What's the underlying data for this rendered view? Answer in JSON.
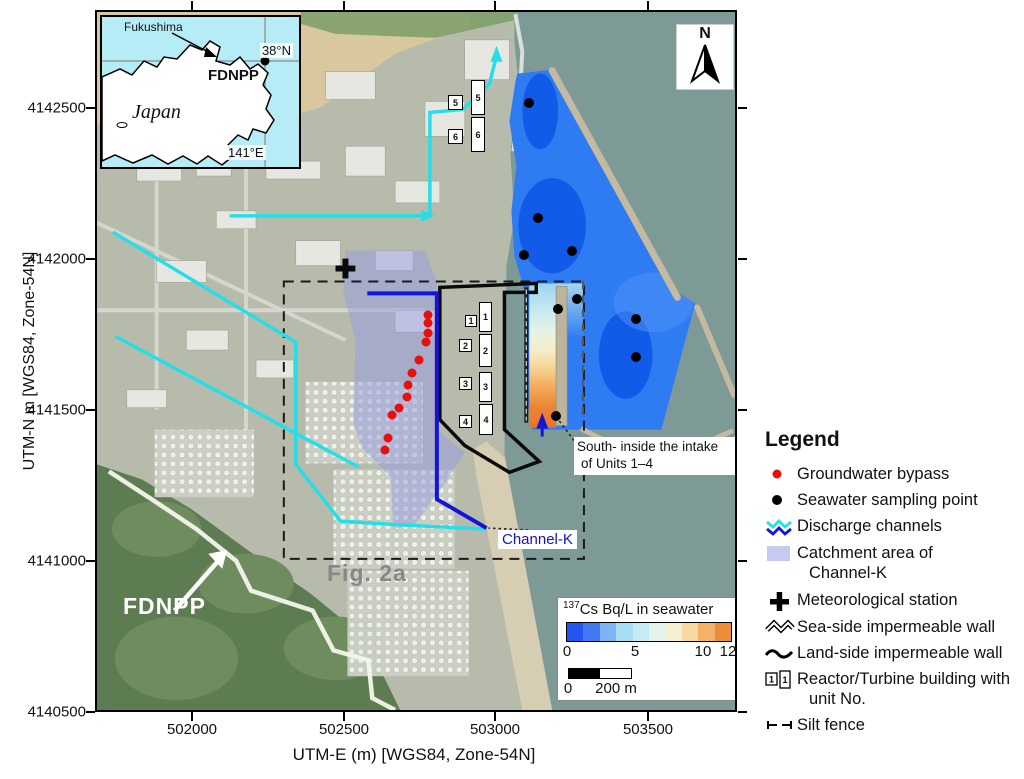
{
  "axes": {
    "y_title": "UTM-N m [WGS84, Zone-54N]",
    "x_title": "UTM-E (m) [WGS84, Zone-54N]",
    "y_ticks": [
      "4142500",
      "4142000",
      "4141500",
      "4141000",
      "4140500"
    ],
    "x_ticks": [
      "502000",
      "502500",
      "503000",
      "503500"
    ]
  },
  "inset": {
    "country": "Japan",
    "prefecture": "Fukushima",
    "site": "FDNPP",
    "lat_line": "38°N",
    "lon_line": "141°E"
  },
  "map": {
    "north_label": "N",
    "fig_label": "Fig. 2a",
    "site_label": "FDNPP",
    "channel_label": "Channel-K",
    "intake_label_line1": "South- inside the intake",
    "intake_label_line2": "of Units 1–4",
    "unit_numbers": [
      "1",
      "2",
      "3",
      "4",
      "5",
      "6"
    ],
    "groundwater_bypass_points": [
      [
        331,
        303
      ],
      [
        331,
        311
      ],
      [
        331,
        321
      ],
      [
        329,
        330
      ],
      [
        322,
        348
      ],
      [
        315,
        361
      ],
      [
        311,
        373
      ],
      [
        310,
        385
      ],
      [
        302,
        396
      ],
      [
        295,
        403
      ],
      [
        291,
        426
      ],
      [
        288,
        438
      ]
    ],
    "seawater_sampling_points": [
      [
        432,
        91
      ],
      [
        441,
        206
      ],
      [
        427,
        243
      ],
      [
        475,
        239
      ],
      [
        461,
        297
      ],
      [
        480,
        287
      ],
      [
        539,
        307
      ],
      [
        539,
        345
      ],
      [
        459,
        404
      ]
    ]
  },
  "colorbar": {
    "isotope_sup": "137",
    "title_rest": "Cs Bq/L in seawater",
    "tick_labels": [
      "0",
      "5",
      "10",
      "12"
    ],
    "segment_colors": [
      "#2356ee",
      "#4479f2",
      "#7db4f5",
      "#a6ddf2",
      "#c5ecf2",
      "#e4f4ea",
      "#f6efd2",
      "#f8d9a2",
      "#f4b167",
      "#ee8c3c"
    ],
    "scale_start": "0",
    "scale_end": "200 m"
  },
  "legend": {
    "title": "Legend",
    "building_icon_number": "1",
    "items": [
      {
        "icon": "red-dot",
        "lines": [
          "Groundwater bypass"
        ]
      },
      {
        "icon": "black-dot",
        "lines": [
          "Seawater sampling point"
        ]
      },
      {
        "icon": "channels",
        "lines": [
          "Discharge channels"
        ]
      },
      {
        "icon": "catchment",
        "lines": [
          "Catchment area of",
          "Channel-K"
        ]
      },
      {
        "icon": "met-station",
        "lines": [
          "Meteorological station"
        ]
      },
      {
        "icon": "sea-wall",
        "lines": [
          "Sea-side impermeable wall"
        ]
      },
      {
        "icon": "land-wall",
        "lines": [
          "Land-side impermeable wall"
        ]
      },
      {
        "icon": "building",
        "lines": [
          "Reactor/Turbine building with",
          "unit No."
        ]
      },
      {
        "icon": "silt-fence",
        "lines": [
          "Silt fence"
        ]
      }
    ]
  },
  "colors": {
    "harbor": "#2f7cf2",
    "harbor_low": "#0f58e8",
    "channel_cyan": "#24dfe8",
    "channel_blue": "#1414d6",
    "catchment": "#969be2",
    "sea": "#7e9a97"
  }
}
